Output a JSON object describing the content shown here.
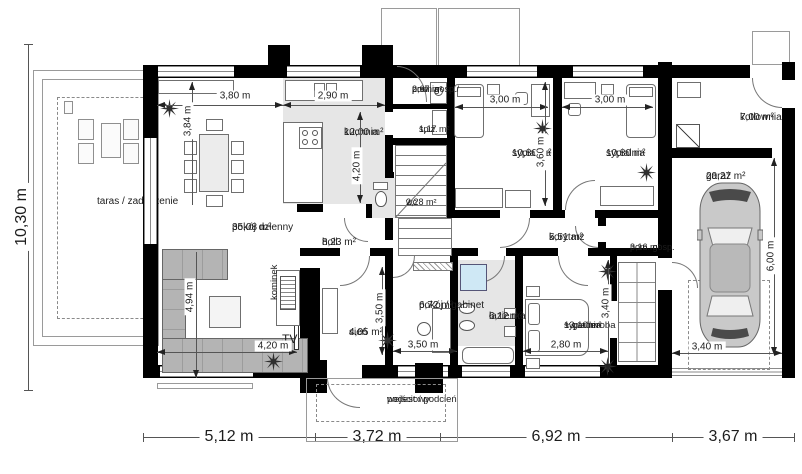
{
  "rooms": {
    "taras": {
      "label": "taras / zadaszenie"
    },
    "pokoj_dzienny": {
      "label": "pokój dzienny",
      "area": "35,08 m²"
    },
    "kuchnia": {
      "label": "kuchnia",
      "area": "12,00 m²"
    },
    "pralnia": {
      "label": "pom. gosp./",
      "label2": "pralnia",
      "area": "2,67 m²"
    },
    "spiz": {
      "label": "spiż.",
      "area": "1,17 m²"
    },
    "wc": {
      "label": "wc",
      "area": "2,28 m²"
    },
    "sypialnia1": {
      "label": "sypialnia",
      "area": "10,80 m²"
    },
    "sypialnia2": {
      "label": "sypialnia",
      "area": "10,80 m²"
    },
    "kotlownia": {
      "label": "kotłownia",
      "area": "7,00 m²"
    },
    "garaz": {
      "label": "garaż",
      "area": "20,27 m²"
    },
    "korytarz": {
      "label": "korytarz",
      "area": "5,51 m²"
    },
    "pom_gosp": {
      "label": "pom. gosp.",
      "area": "3,16 m²"
    },
    "holl": {
      "label": "holl",
      "area": "8,23 m²"
    },
    "sien": {
      "label": "sień",
      "area": "4,05 m²"
    },
    "gabinet": {
      "label": "pokój / gabinet",
      "area": "6,72 m²"
    },
    "lazienka": {
      "label": "łazienka",
      "area": "6,12 m²"
    },
    "syp_garderoba": {
      "label": "sypialnia",
      "label2": "+ garderoba",
      "area": "13,10 m²"
    },
    "podest": {
      "label": "podest / podcień",
      "label2": "wejściowy"
    },
    "kominek": {
      "label": "kominek"
    },
    "tv": {
      "label": "TV"
    }
  },
  "dims": {
    "total_height": "10,30 m",
    "bottom_segments": [
      "5,12 m",
      "3,72 m",
      "6,92 m",
      "3,67 m"
    ],
    "living_w": "3,80 m",
    "living_h": "3,84 m",
    "kitchen_w": "2,90 m",
    "kitchen_h": "4,20 m",
    "bed1_w": "3,00 m",
    "bed2_w": "3,00 m",
    "bed_h": "3,60 m",
    "sofa_h": "4,94 m",
    "tv_wall": "4,20 m",
    "office_h": "3,50 m",
    "office_w": "3,50 m",
    "bed3_w": "2,80 m",
    "bed3_h": "3,40 m",
    "garage_h": "6,00 m",
    "garage_w": "3,40 m"
  },
  "colors": {
    "wall": "#000000",
    "floor_gray": "#e6e6e6",
    "sofa_gray": "#b4b4b4",
    "shower_blue": "#cfe8f5",
    "car_gray": "#c9c9c9"
  }
}
